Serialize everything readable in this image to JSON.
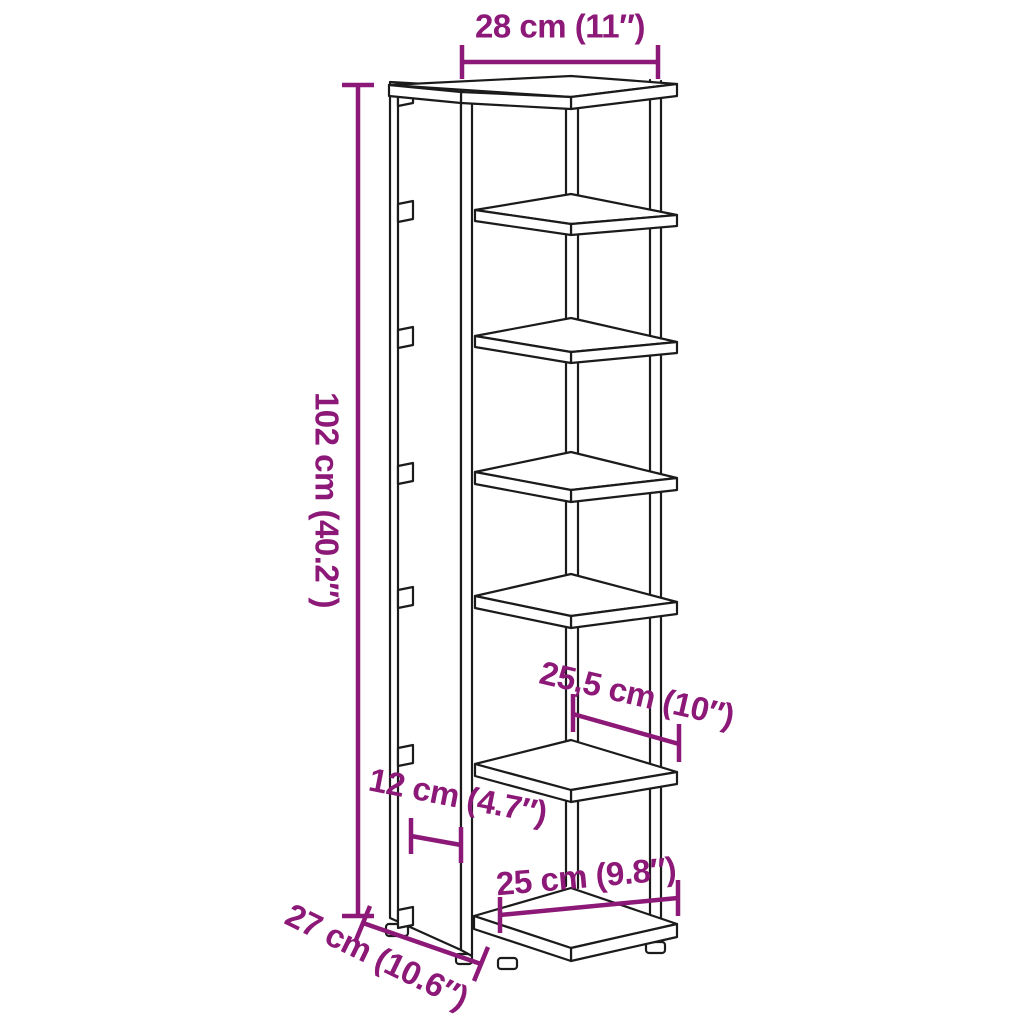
{
  "diagram": {
    "background_color": "#ffffff",
    "line_art_color": "#1b1b1b",
    "dimension_color": "#8C1877",
    "dimensions": {
      "front_width": "28 cm (11″)",
      "height": "102 cm (40.2″)",
      "shelf_width": "25,5 cm (10″)",
      "side_depth": "12 cm (4.7″)",
      "base_width": "25 cm (9.8″)",
      "depth": "27 cm (10.6″)"
    }
  }
}
